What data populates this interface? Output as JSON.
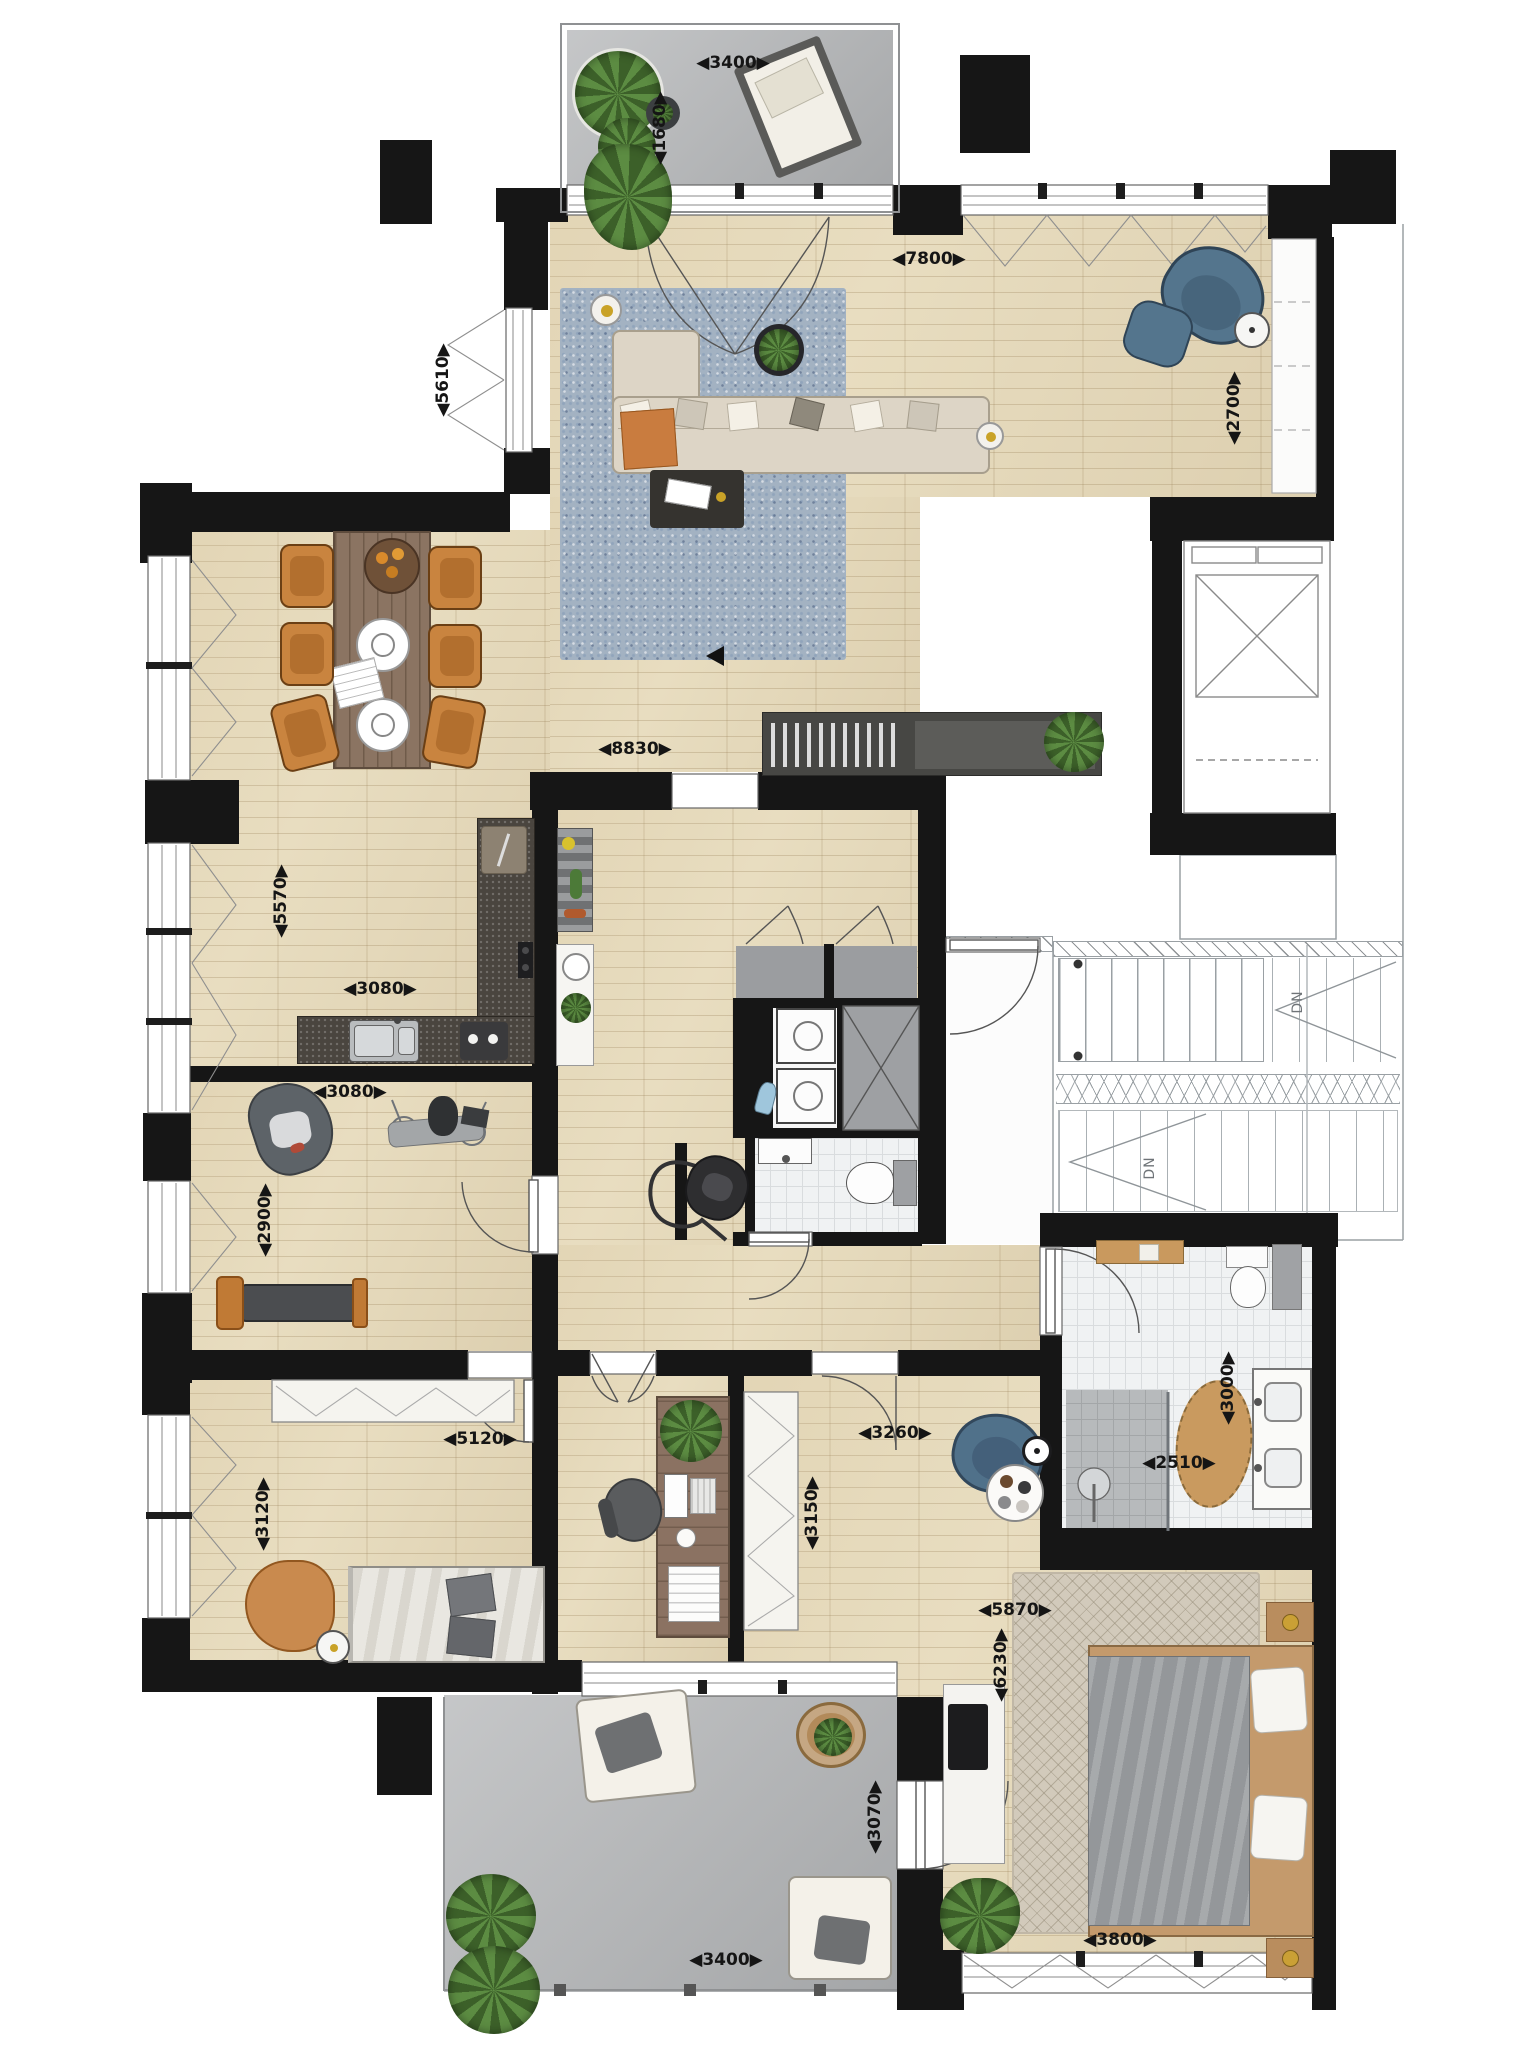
{
  "dimensions": {
    "balcony_top_width": "◀3400▶",
    "balcony_top_depth": "◀1680▶",
    "living_width": "◀7800▶",
    "living_depth_right": "◀2700▶",
    "living_depth_left": "◀5610▶",
    "open_plan_width": "◀8830▶",
    "dining_depth": "◀5570▶",
    "kitchen_width": "◀3080▶",
    "gym_width": "◀3080▶",
    "gym_depth": "◀2900▶",
    "bedroom2_width": "◀5120▶",
    "bedroom2_depth": "◀3120▶",
    "office_depth": "◀3150▶",
    "master_entry_width": "◀3260▶",
    "bathroom_width": "◀2510▶",
    "bathroom_depth": "◀3000▶",
    "master_width": "◀5870▶",
    "master_depth": "◀6230▶",
    "balcony_bottom_depth": "◀3070▶",
    "balcony_bottom_width": "◀3400▶",
    "master_bed_width": "◀3800▶"
  },
  "stairwell": {
    "down_upper": "DN",
    "down_lower": "DN"
  },
  "colors": {
    "wall": "#161616",
    "wood_floor": "#e8ddc0",
    "balcony_floor": "#b2b4b6",
    "tile_floor": "#f0f2f3",
    "kitchen_counter": "#4a453f",
    "dining_chair_orange": "#c9843f",
    "armchair_blue": "#54758d",
    "rug_blue": "#a3b2c2",
    "rug_master": "#d2cabb",
    "plant_green": "#4c7a38"
  },
  "furniture_icons": [
    "sofa-icon",
    "rug-icon",
    "coffee-table-icon",
    "armchair-icon",
    "floor-lamp-icon",
    "plant-icon",
    "dining-table-icon",
    "dining-chair-icon",
    "kitchen-counter-icon",
    "sink-icon",
    "cooktop-icon",
    "washer-icon",
    "dryer-icon",
    "toilet-icon",
    "shower-icon",
    "vanity-icon",
    "bed-icon",
    "wardrobe-icon",
    "desk-icon",
    "office-chair-icon",
    "exercise-machine-icon",
    "weight-bench-icon",
    "punching-bag-icon",
    "vacuum-icon",
    "lounge-chair-icon",
    "elevator-icon",
    "stairs-icon"
  ]
}
